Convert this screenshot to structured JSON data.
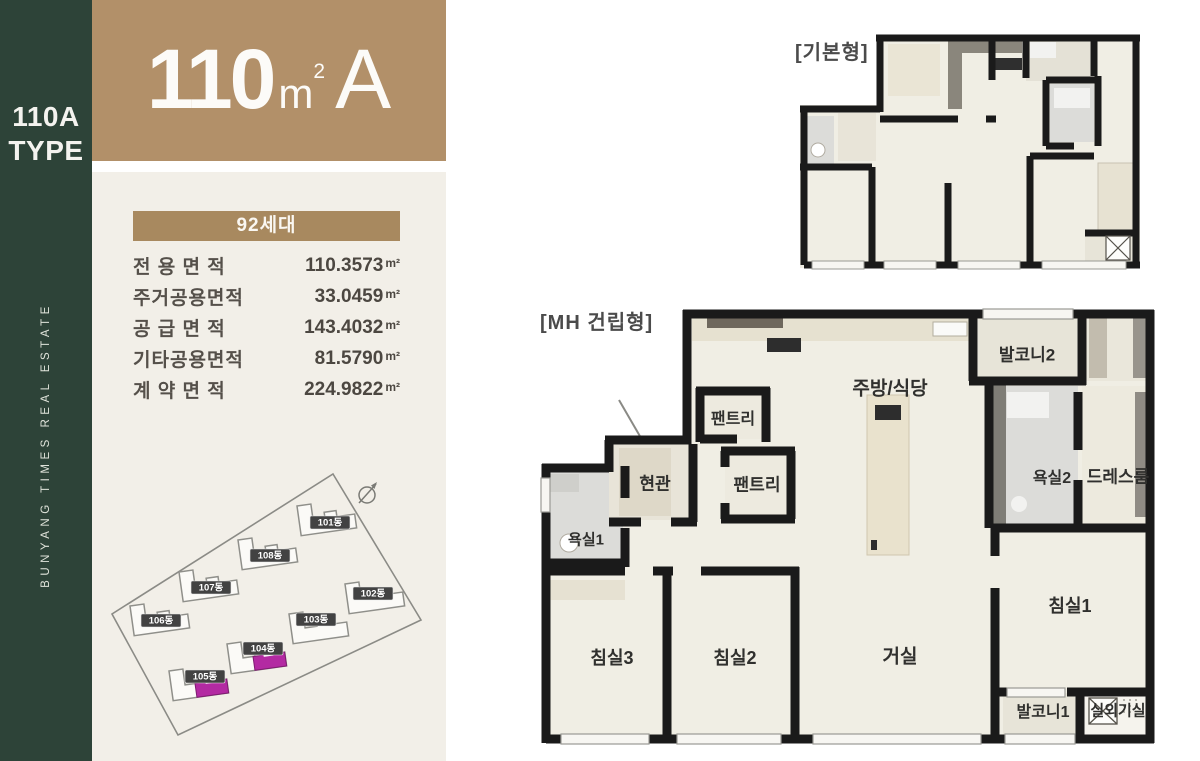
{
  "sidebar": {
    "type_label": "110A\nTYPE",
    "brand_text": "BUNYANG TIMES REAL ESTATE",
    "bg_color": "#2d4338"
  },
  "header": {
    "area_number": "110",
    "area_unit": "m",
    "area_exponent": "2",
    "type_letter": "A",
    "bg_color": "#b29069"
  },
  "info": {
    "units_badge": "92세대",
    "table": {
      "rows": [
        {
          "label": "전 용 면 적",
          "value": "110.3573",
          "unit": "m²"
        },
        {
          "label": "주거공용면적",
          "value": "33.0459",
          "unit": "m²"
        },
        {
          "label": "공 급 면 적",
          "value": "143.4032",
          "unit": "m²"
        },
        {
          "label": "기타공용면적",
          "value": "81.5790",
          "unit": "m²"
        },
        {
          "label": "계 약 면 적",
          "value": "224.9822",
          "unit": "m²"
        }
      ]
    }
  },
  "site_plan": {
    "highlight_color": "#b32aa2",
    "buildings": [
      {
        "label": "101동",
        "highlighted": false
      },
      {
        "label": "102동",
        "highlighted": false
      },
      {
        "label": "103동",
        "highlighted": false
      },
      {
        "label": "104동",
        "highlighted": true
      },
      {
        "label": "105동",
        "highlighted": true
      },
      {
        "label": "106동",
        "highlighted": false
      },
      {
        "label": "107동",
        "highlighted": false
      },
      {
        "label": "108동",
        "highlighted": false
      }
    ]
  },
  "plans": {
    "basic": {
      "tag": "[기본형]"
    },
    "mh": {
      "tag": "[MH 건립형]",
      "rooms": {
        "pantry1": "팬트리",
        "pantry2": "팬트리",
        "entrance": "현관",
        "kitchen": "주방/식당",
        "balcony2": "발코니2",
        "bath2": "욕실2",
        "dressroom": "드레스룸",
        "bath1": "욕실1",
        "bed3": "침실3",
        "bed2": "침실2",
        "living": "거실",
        "bed1": "침실1",
        "balcony1": "발코니1",
        "outdoor_unit": "실외기실"
      }
    }
  }
}
